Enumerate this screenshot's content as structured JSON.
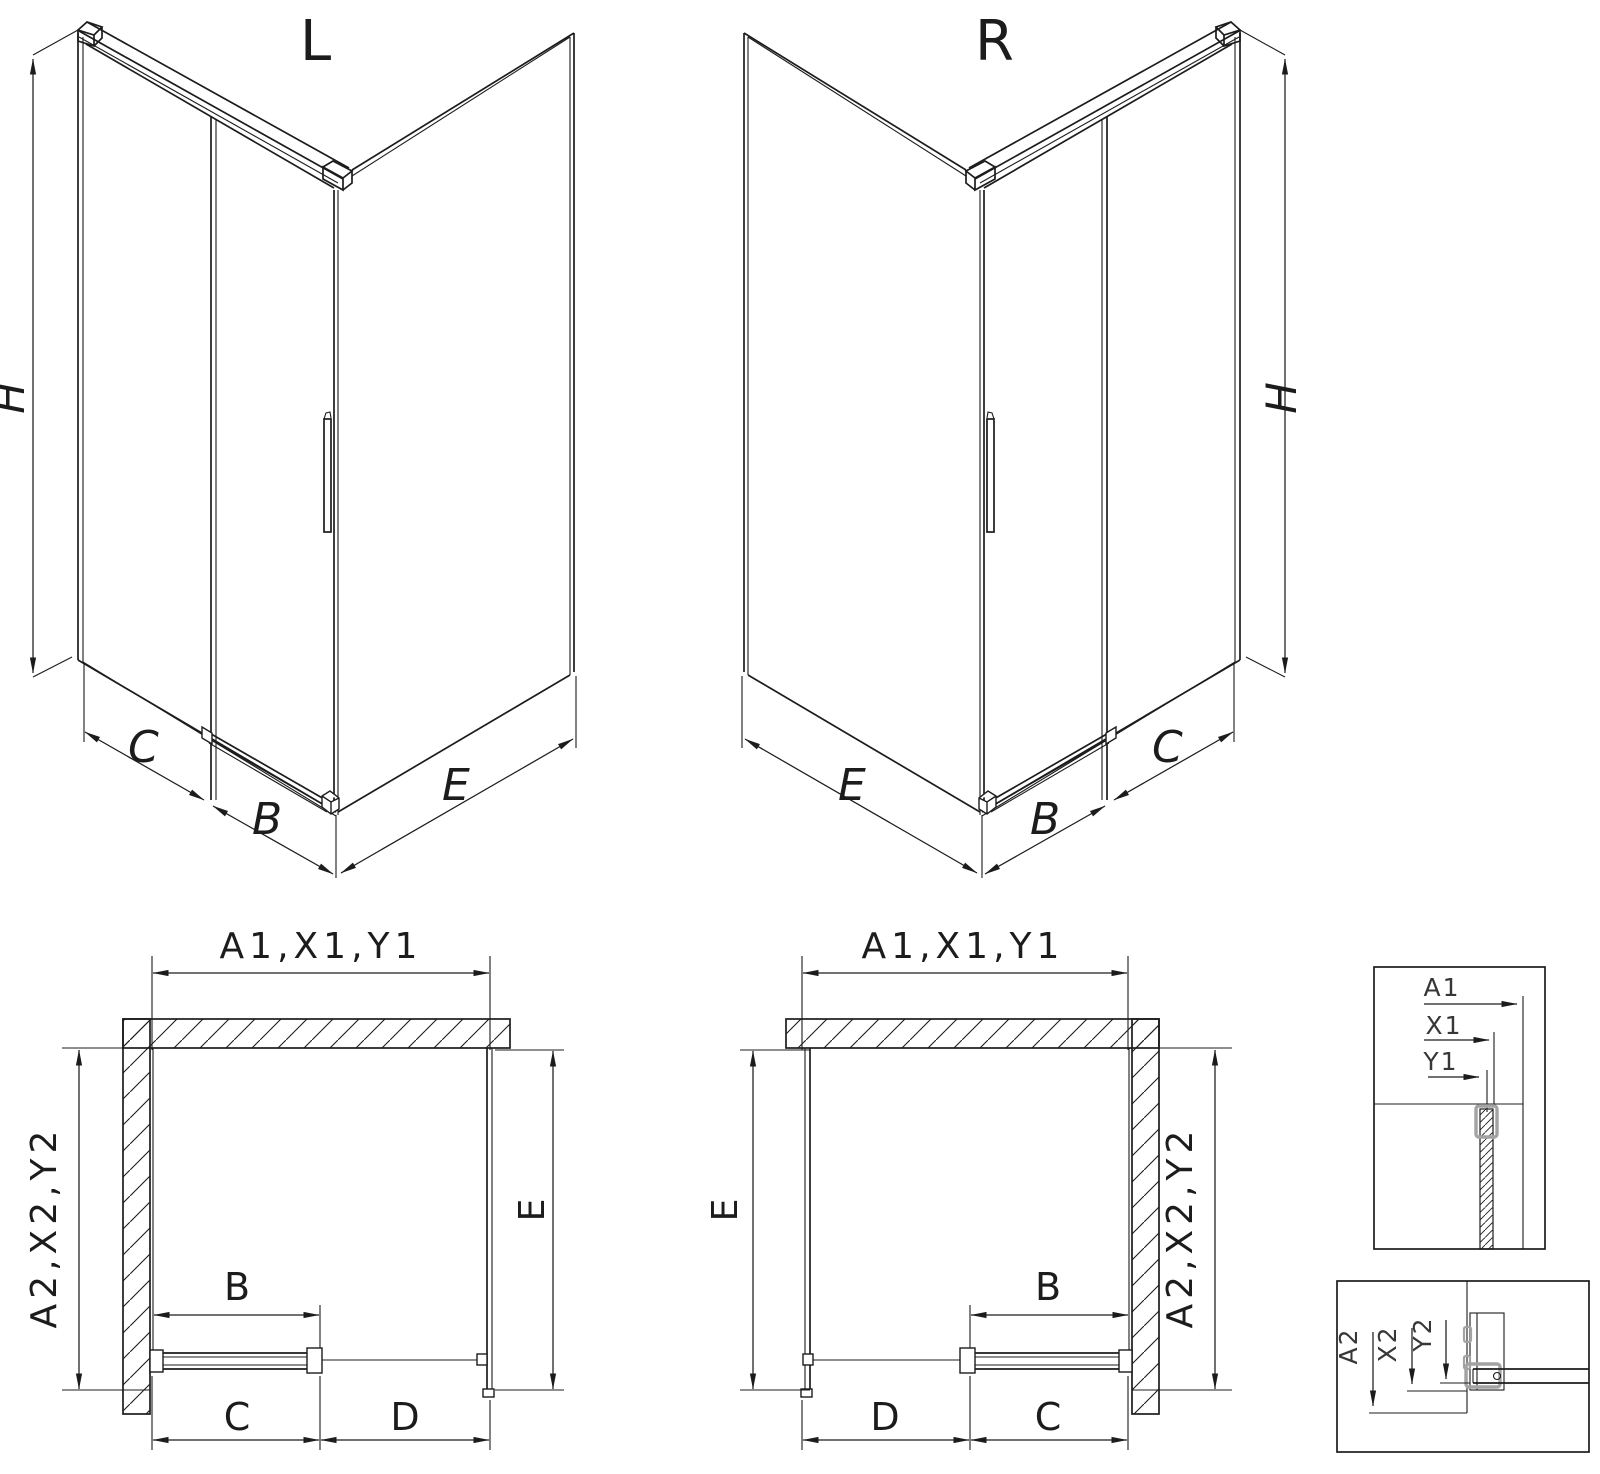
{
  "colors": {
    "line": "#1c1c1c",
    "highlight_gray": "#a3a3a3",
    "background": "#ffffff"
  },
  "iso_left": {
    "variant": "L",
    "height_dim": "H",
    "fixed_panel_dim": "C",
    "door_dim": "B",
    "side_panel_dim": "E"
  },
  "iso_right": {
    "variant": "R",
    "height_dim": "H",
    "fixed_panel_dim": "C",
    "door_dim": "B",
    "side_panel_dim": "E"
  },
  "plan_left": {
    "width_dim": "A1,X1,Y1",
    "depth_dim": "A2,X2,Y2",
    "side_dim": "E",
    "door_dim": "B",
    "fixed_dim": "C",
    "opening_dim": "D"
  },
  "plan_right": {
    "width_dim": "A1,X1,Y1",
    "depth_dim": "A2,X2,Y2",
    "side_dim": "E",
    "door_dim": "B",
    "fixed_dim": "C",
    "opening_dim": "D"
  },
  "detail_width": {
    "labels": [
      "A1",
      "X1",
      "Y1"
    ]
  },
  "detail_depth": {
    "labels": [
      "A2",
      "X2",
      "Y2"
    ]
  }
}
